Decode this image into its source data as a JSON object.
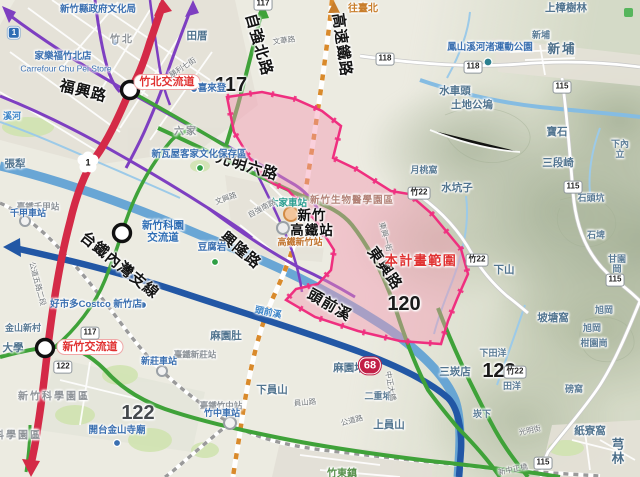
{
  "map": {
    "colors": {
      "freeway_red": "#d42a47",
      "expressway_blue": "#2257a5",
      "provincial_green": "#3fa239",
      "local_purple": "#7e3fc1",
      "rail_orange": "#d98a2b",
      "rail_gray": "#9a9a9a",
      "river_blue": "#5b9fd4",
      "plan_fill": "#f396b2",
      "plan_border": "#ef2f7f"
    },
    "plan_area": {
      "label": "本計畫範圍"
    },
    "labels": [
      {
        "t": "福興路",
        "x": 83,
        "y": 92,
        "c": "bigroad",
        "r": 14,
        "n": "road-label-fuxing"
      },
      {
        "t": "自強北路",
        "x": 258,
        "y": 45,
        "c": "bigroad",
        "r": 74,
        "n": "road-label-ziqiang-north"
      },
      {
        "t": "高速鐵路",
        "x": 341,
        "y": 45,
        "c": "bigroad",
        "r": 82,
        "n": "rail-label-hsr"
      },
      {
        "t": "光明六路",
        "x": 247,
        "y": 167,
        "c": "bigroad",
        "r": 17,
        "n": "road-label-guangming-6"
      },
      {
        "t": "興隆路",
        "x": 240,
        "y": 251,
        "c": "bigroad",
        "r": 40,
        "n": "road-label-xinglong"
      },
      {
        "t": "東興路",
        "x": 384,
        "y": 269,
        "c": "bigroad",
        "r": 55,
        "n": "road-label-dongxing"
      },
      {
        "t": "頭前溪",
        "x": 329,
        "y": 306,
        "c": "bigroad",
        "r": 30,
        "n": "river-label-touqian"
      },
      {
        "t": "台鐵內灣支線",
        "x": 119,
        "y": 266,
        "c": "bigroad",
        "r": 39,
        "n": "rail-label-neiwan-branch"
      },
      {
        "t": "新竹\n高鐵站",
        "x": 312,
        "y": 224,
        "c": "bigsta",
        "n": "hsr-station-label"
      },
      {
        "t": "117",
        "x": 231,
        "y": 85,
        "c": "bignum",
        "n": "route-117-number"
      },
      {
        "t": "120",
        "x": 404,
        "y": 304,
        "c": "bignum",
        "n": "route-120-number"
      },
      {
        "t": "122",
        "x": 138,
        "y": 413,
        "c": "bignumg",
        "n": "route-122-number"
      },
      {
        "t": "123",
        "x": 499,
        "y": 371,
        "c": "bignum",
        "n": "route-123-number"
      },
      {
        "t": "本計畫範圍",
        "x": 421,
        "y": 261,
        "c": "plan",
        "n": "plan-area-label"
      },
      {
        "t": "竹北交流道",
        "x": 167,
        "y": 82,
        "c": "bubble",
        "n": "zhubei-interchange-label"
      },
      {
        "t": "新竹交流道",
        "x": 90,
        "y": 347,
        "c": "bubble",
        "n": "hsinchu-interchange-label"
      },
      {
        "t": "新竹科園\n交流道",
        "x": 163,
        "y": 232,
        "c": "icblue",
        "n": "science-park-interchange-label"
      },
      {
        "t": "往臺北",
        "x": 363,
        "y": 9,
        "c": "dir",
        "n": "northbound-taipei-label"
      },
      {
        "t": "田厝",
        "x": 197,
        "y": 37,
        "c": "place"
      },
      {
        "t": "上樟樹林",
        "x": 566,
        "y": 9,
        "c": "place"
      },
      {
        "t": "新埔",
        "x": 541,
        "y": 36,
        "c": "place-sm"
      },
      {
        "t": "新埔",
        "x": 562,
        "y": 50,
        "c": "place-lg"
      },
      {
        "t": "水車頭",
        "x": 455,
        "y": 92,
        "c": "place"
      },
      {
        "t": "土地公塢",
        "x": 472,
        "y": 106,
        "c": "place"
      },
      {
        "t": "月桃窩",
        "x": 424,
        "y": 171,
        "c": "place-sm"
      },
      {
        "t": "水坑子",
        "x": 457,
        "y": 189,
        "c": "place"
      },
      {
        "t": "下山",
        "x": 504,
        "y": 271,
        "c": "place"
      },
      {
        "t": "寶石",
        "x": 557,
        "y": 133,
        "c": "place"
      },
      {
        "t": "下內立",
        "x": 620,
        "y": 150,
        "c": "place-sm"
      },
      {
        "t": "三段崎",
        "x": 558,
        "y": 164,
        "c": "place"
      },
      {
        "t": "石頭坑",
        "x": 591,
        "y": 199,
        "c": "place-sm"
      },
      {
        "t": "石埤",
        "x": 596,
        "y": 236,
        "c": "place-sm"
      },
      {
        "t": "甘園岡",
        "x": 617,
        "y": 265,
        "c": "place-sm"
      },
      {
        "t": "坡塘窩",
        "x": 553,
        "y": 319,
        "c": "place"
      },
      {
        "t": "旭岡",
        "x": 604,
        "y": 311,
        "c": "place-sm"
      },
      {
        "t": "旭岡",
        "x": 592,
        "y": 329,
        "c": "place-sm"
      },
      {
        "t": "柑園崗",
        "x": 594,
        "y": 344,
        "c": "place-sm"
      },
      {
        "t": "磅窩",
        "x": 574,
        "y": 390,
        "c": "place-sm"
      },
      {
        "t": "紙寮窩",
        "x": 590,
        "y": 432,
        "c": "place"
      },
      {
        "t": "下田洋",
        "x": 493,
        "y": 354,
        "c": "place-sm"
      },
      {
        "t": "三崁店",
        "x": 455,
        "y": 373,
        "c": "place"
      },
      {
        "t": "田洋",
        "x": 512,
        "y": 387,
        "c": "place-sm"
      },
      {
        "t": "崁下",
        "x": 482,
        "y": 415,
        "c": "place-sm"
      },
      {
        "t": "麻園肚",
        "x": 226,
        "y": 337,
        "c": "place"
      },
      {
        "t": "麻園堵",
        "x": 349,
        "y": 369,
        "c": "place"
      },
      {
        "t": "下員山",
        "x": 272,
        "y": 391,
        "c": "place"
      },
      {
        "t": "二重埔",
        "x": 378,
        "y": 397,
        "c": "place-sm"
      },
      {
        "t": "上員山",
        "x": 389,
        "y": 426,
        "c": "place"
      },
      {
        "t": "張犁",
        "x": 15,
        "y": 165,
        "c": "place"
      },
      {
        "t": "大學",
        "x": 13,
        "y": 349,
        "c": "place"
      },
      {
        "t": "金山新村",
        "x": 23,
        "y": 329,
        "c": "place-sm"
      },
      {
        "t": "溪河",
        "x": 12,
        "y": 117,
        "c": "water"
      },
      {
        "t": "芎林",
        "x": 619,
        "y": 452,
        "c": "place-lg"
      },
      {
        "t": "竹東鎮",
        "x": 342,
        "y": 474,
        "c": "green"
      },
      {
        "t": "竹北",
        "x": 122,
        "y": 40,
        "c": "gray"
      },
      {
        "t": "六家",
        "x": 186,
        "y": 132,
        "c": "gray"
      },
      {
        "t": "新竹縣政府文化局",
        "x": 98,
        "y": 10,
        "c": "poi"
      },
      {
        "t": "家樂福竹北店",
        "x": 63,
        "y": 57,
        "c": "poi"
      },
      {
        "t": "Carrefour Chu Pei Store",
        "x": 66,
        "y": 69,
        "c": "poi-lat"
      },
      {
        "t": "喜來登",
        "x": 212,
        "y": 89,
        "c": "poi"
      },
      {
        "t": "鳳山溪河渚運動公園",
        "x": 490,
        "y": 48,
        "c": "poi"
      },
      {
        "t": "新瓦屋客家文化保存區",
        "x": 199,
        "y": 155,
        "c": "poi"
      },
      {
        "t": "好市多Costco 新竹店",
        "x": 96,
        "y": 305,
        "c": "poi"
      },
      {
        "t": "開台金山寺廟",
        "x": 117,
        "y": 431,
        "c": "poi"
      },
      {
        "t": "豆腐岩",
        "x": 212,
        "y": 248,
        "c": "poi"
      },
      {
        "t": "新竹生物醫學園區",
        "x": 352,
        "y": 201,
        "c": "landuse"
      },
      {
        "t": "新竹科學園區",
        "x": 54,
        "y": 397,
        "c": "gray"
      },
      {
        "t": "科學園區",
        "x": 18,
        "y": 436,
        "c": "gray"
      },
      {
        "t": "臺鐵竹中站",
        "x": 221,
        "y": 406,
        "c": "sta-gray"
      },
      {
        "t": "竹中車站",
        "x": 222,
        "y": 414,
        "c": "sta-blue"
      },
      {
        "t": "臺鐵新莊站",
        "x": 195,
        "y": 355,
        "c": "sta-gray"
      },
      {
        "t": "新莊車站",
        "x": 159,
        "y": 362,
        "c": "sta-blue"
      },
      {
        "t": "臺鐵千甲站",
        "x": 38,
        "y": 207,
        "c": "sta-gray"
      },
      {
        "t": "千甲車站",
        "x": 28,
        "y": 214,
        "c": "sta-blue"
      },
      {
        "t": "六家車站",
        "x": 288,
        "y": 204,
        "c": "sta-teal"
      },
      {
        "t": "高鐵新竹站",
        "x": 300,
        "y": 243,
        "c": "sta-or"
      },
      {
        "t": "文華路",
        "x": 284,
        "y": 41,
        "c": "street",
        "r": -8
      },
      {
        "t": "勝利七街",
        "x": 183,
        "y": 68,
        "c": "street",
        "r": -33
      },
      {
        "t": "文興路",
        "x": 226,
        "y": 199,
        "c": "street",
        "r": -20
      },
      {
        "t": "自強南路",
        "x": 262,
        "y": 209,
        "c": "street",
        "r": -28
      },
      {
        "t": "東興一街",
        "x": 385,
        "y": 237,
        "c": "street",
        "r": 75
      },
      {
        "t": "員山路",
        "x": 305,
        "y": 403,
        "c": "street",
        "r": -5
      },
      {
        "t": "公道路",
        "x": 352,
        "y": 421,
        "c": "street",
        "r": -15
      },
      {
        "t": "中正大橋",
        "x": 390,
        "y": 386,
        "c": "street",
        "r": 80
      },
      {
        "t": "公道五路二段",
        "x": 37,
        "y": 284,
        "c": "street",
        "r": 75
      },
      {
        "t": "光明街",
        "x": 530,
        "y": 431,
        "c": "street",
        "r": -12
      },
      {
        "t": "新中正橋",
        "x": 513,
        "y": 470,
        "c": "street",
        "r": -12
      },
      {
        "t": "頭前溪",
        "x": 268,
        "y": 313,
        "c": "water",
        "r": 12
      }
    ],
    "shields": {
      "white": [
        {
          "t": "117",
          "x": 263,
          "y": 4
        },
        {
          "t": "117",
          "x": 90,
          "y": 333
        },
        {
          "t": "122",
          "x": 63,
          "y": 367
        },
        {
          "t": "118",
          "x": 385,
          "y": 59
        },
        {
          "t": "118",
          "x": 473,
          "y": 67
        },
        {
          "t": "115",
          "x": 562,
          "y": 87
        },
        {
          "t": "115",
          "x": 573,
          "y": 187
        },
        {
          "t": "115",
          "x": 615,
          "y": 280
        },
        {
          "t": "115",
          "x": 543,
          "y": 463
        },
        {
          "t": "竹22",
          "x": 419,
          "y": 193
        },
        {
          "t": "竹22",
          "x": 477,
          "y": 260
        },
        {
          "t": "竹22",
          "x": 515,
          "y": 372
        }
      ],
      "expressway": {
        "t": "68",
        "x": 370,
        "y": 366
      },
      "blue": {
        "t": "1",
        "x": 14,
        "y": 33
      },
      "freeway_blossom": {
        "t": "1",
        "x": 88,
        "y": 162
      }
    }
  }
}
